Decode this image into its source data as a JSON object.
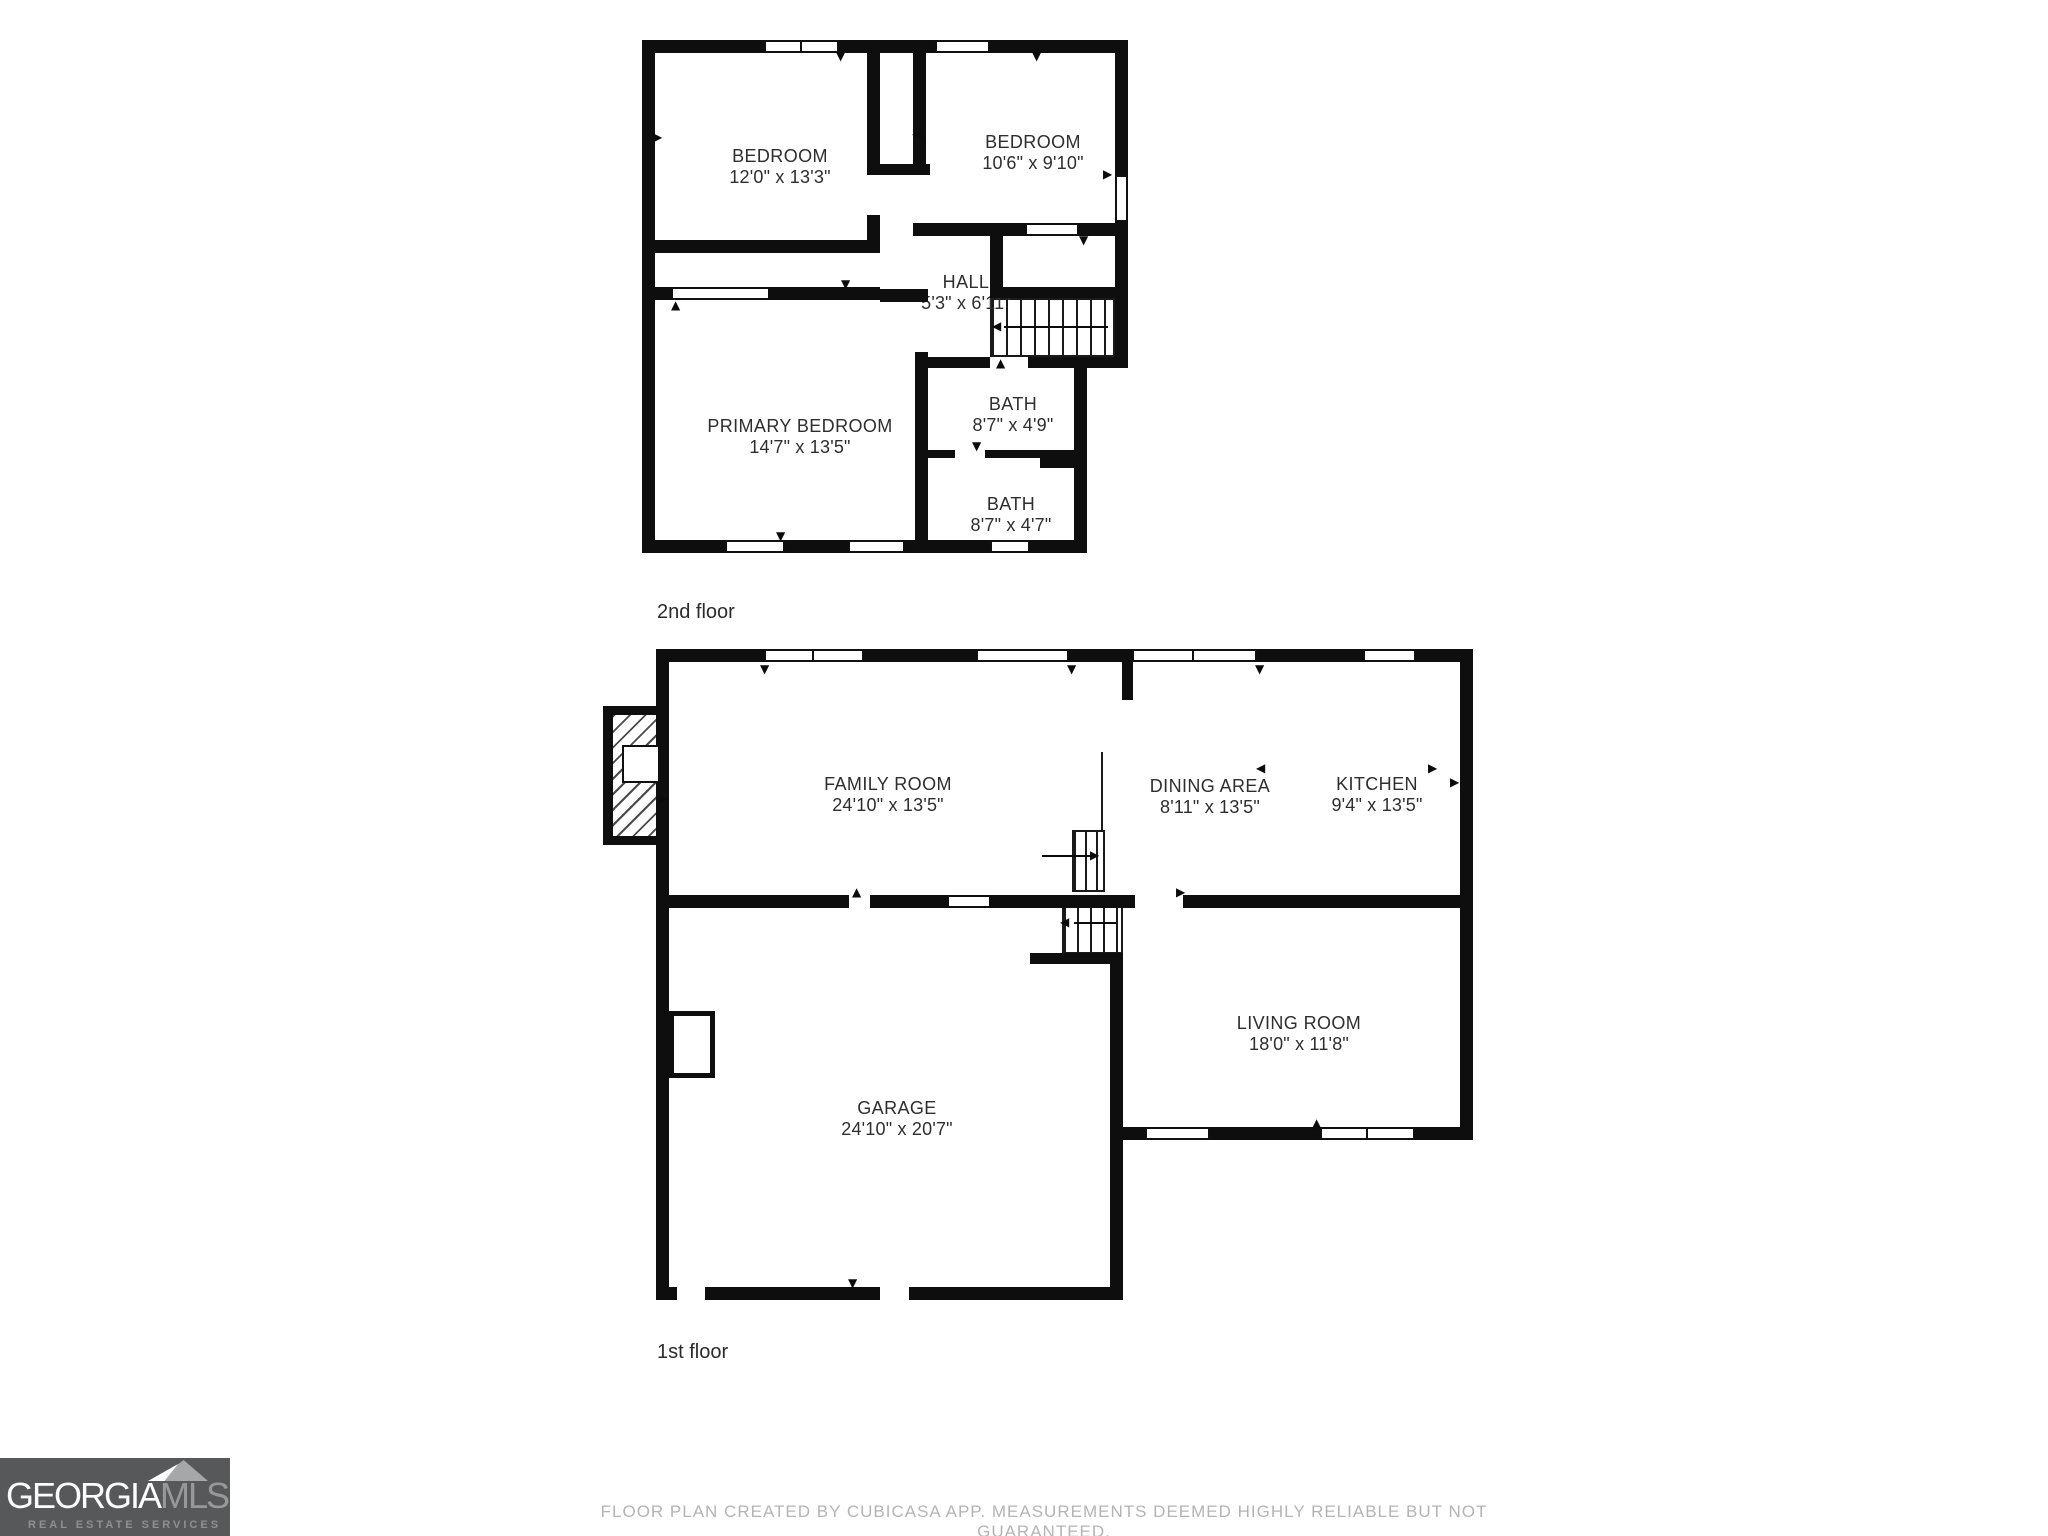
{
  "floors": [
    {
      "label": "2nd floor",
      "rooms": [
        {
          "name": "BEDROOM",
          "dims": "12'0\" x 13'3\""
        },
        {
          "name": "BEDROOM",
          "dims": "10'6\" x 9'10\""
        },
        {
          "name": "HALL",
          "dims": "5'3\" x 6'11\""
        },
        {
          "name": "BATH",
          "dims": "8'7\" x 4'9\""
        },
        {
          "name": "BATH",
          "dims": "8'7\" x 4'7\""
        },
        {
          "name": "PRIMARY BEDROOM",
          "dims": "14'7\" x 13'5\""
        }
      ]
    },
    {
      "label": "1st floor",
      "rooms": [
        {
          "name": "FAMILY ROOM",
          "dims": "24'10\" x 13'5\""
        },
        {
          "name": "DINING AREA",
          "dims": "8'11\" x 13'5\""
        },
        {
          "name": "KITCHEN",
          "dims": "9'4\" x 13'5\""
        },
        {
          "name": "LIVING ROOM",
          "dims": "18'0\" x 11'8\""
        },
        {
          "name": "GARAGE",
          "dims": "24'10\" x 20'7\""
        }
      ]
    }
  ],
  "footer": {
    "disclaimer": "FLOOR PLAN CREATED BY CUBICASA APP. MEASUREMENTS DEEMED HIGHLY RELIABLE BUT NOT GUARANTEED."
  },
  "logo": {
    "brand_primary": "GEORGIA",
    "brand_secondary": "MLS",
    "tagline": "REAL ESTATE SERVICES"
  },
  "colors": {
    "wall": "#0e0e0e",
    "logo_background": "#57585a",
    "logo_secondary_text": "#97989a",
    "disclaimer_text": "#b4b4b4"
  }
}
